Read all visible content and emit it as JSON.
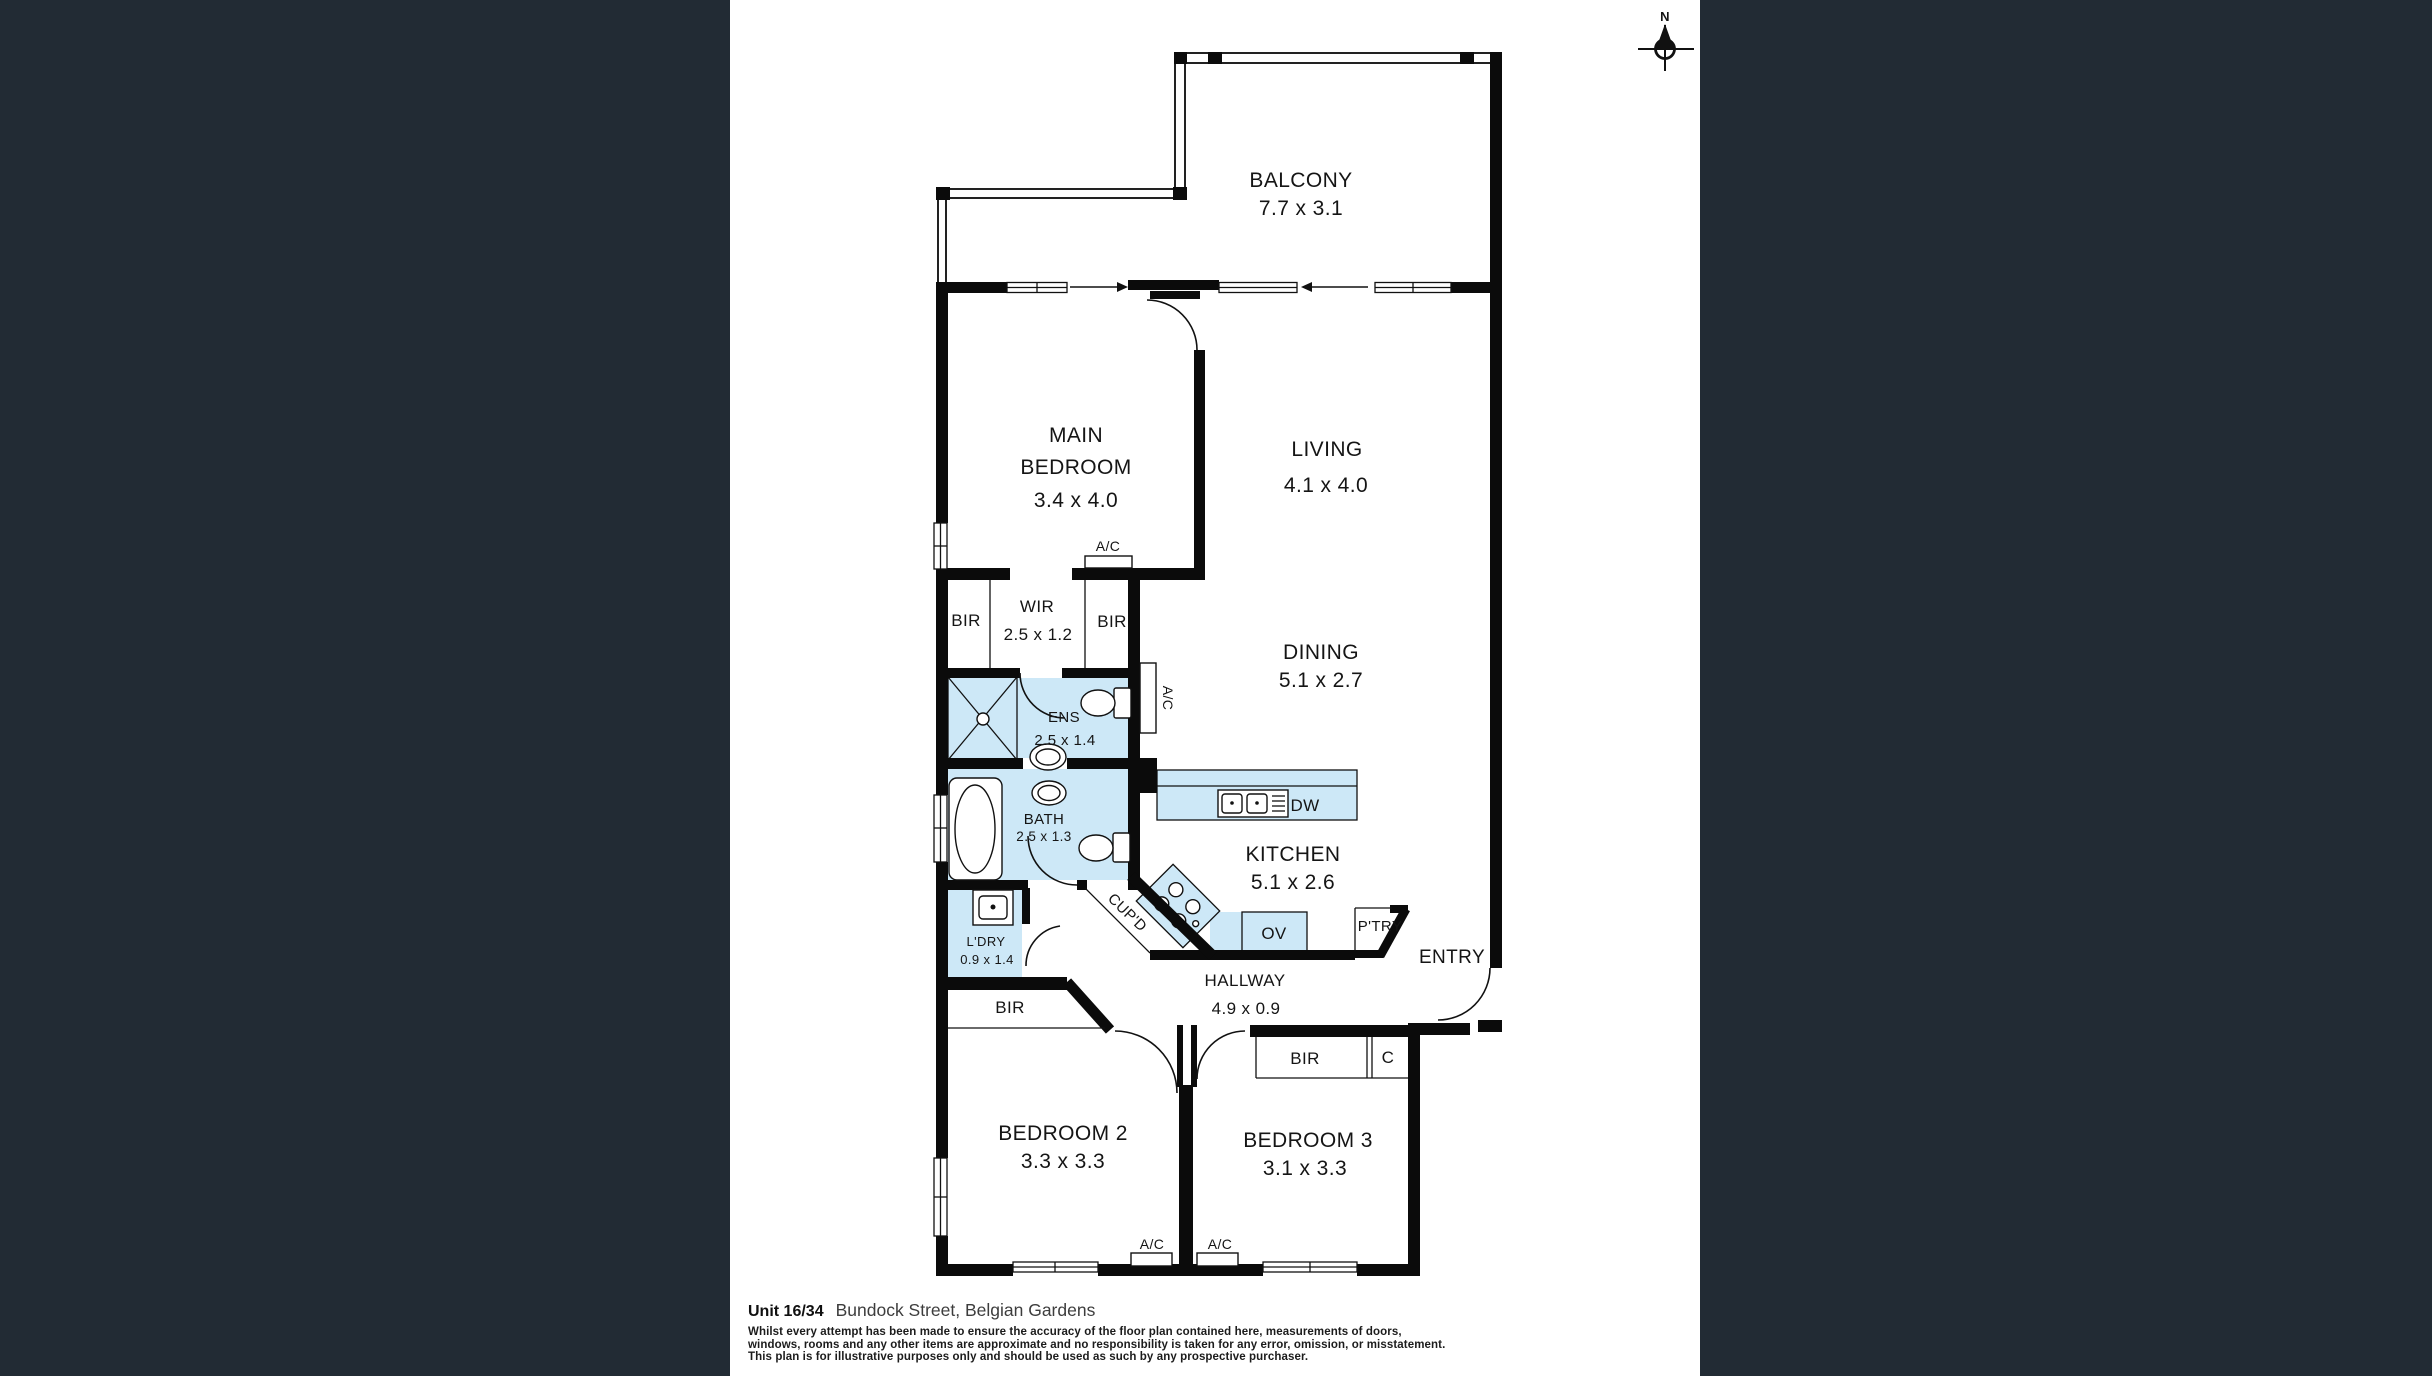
{
  "colors": {
    "background": "#222b34",
    "paper": "#ffffff",
    "wet_area": "#cde8f7",
    "wall": "#0b0b0b"
  },
  "compass": {
    "north_label": "N"
  },
  "rooms": {
    "balcony": {
      "name": "BALCONY",
      "dims": "7.7 x 3.1"
    },
    "main_bedroom": {
      "name_line1": "MAIN",
      "name_line2": "BEDROOM",
      "dims": "3.4 x 4.0"
    },
    "living": {
      "name": "LIVING",
      "dims": "4.1 x 4.0"
    },
    "dining": {
      "name": "DINING",
      "dims": "5.1 x 2.7"
    },
    "wir": {
      "name": "WIR",
      "dims": "2.5 x 1.2"
    },
    "ens": {
      "name": "ENS",
      "dims": "2.5 x 1.4"
    },
    "bath": {
      "name": "BATH",
      "dims": "2.5 x 1.3"
    },
    "kitchen": {
      "name": "KITCHEN",
      "dims": "5.1 x 2.6"
    },
    "laundry": {
      "name": "L'DRY",
      "dims": "0.9 x 1.4"
    },
    "hallway": {
      "name": "HALLWAY",
      "dims": "4.9 x 0.9"
    },
    "bedroom2": {
      "name": "BEDROOM 2",
      "dims": "3.3 x 3.3"
    },
    "bedroom3": {
      "name": "BEDROOM 3",
      "dims": "3.1 x 3.3"
    },
    "entry": {
      "name": "ENTRY"
    }
  },
  "fixtures": {
    "bir": "BIR",
    "closet": "C",
    "cupboard": "CUP'D",
    "pantry": "P'TRY",
    "dishwasher": "DW",
    "oven": "OV",
    "aircon": "A/C"
  },
  "footer": {
    "unit": "Unit 16/34",
    "address": "Bundock Street, Belgian Gardens",
    "disclaimer_lines": [
      "Whilst every attempt has been made to ensure the accuracy of the floor plan contained here, measurements of doors,",
      "windows, rooms and any other items are approximate and no responsibility is taken for any error, omission, or misstatement.",
      "This plan is for illustrative purposes only and should be used as such by any prospective purchaser."
    ]
  }
}
